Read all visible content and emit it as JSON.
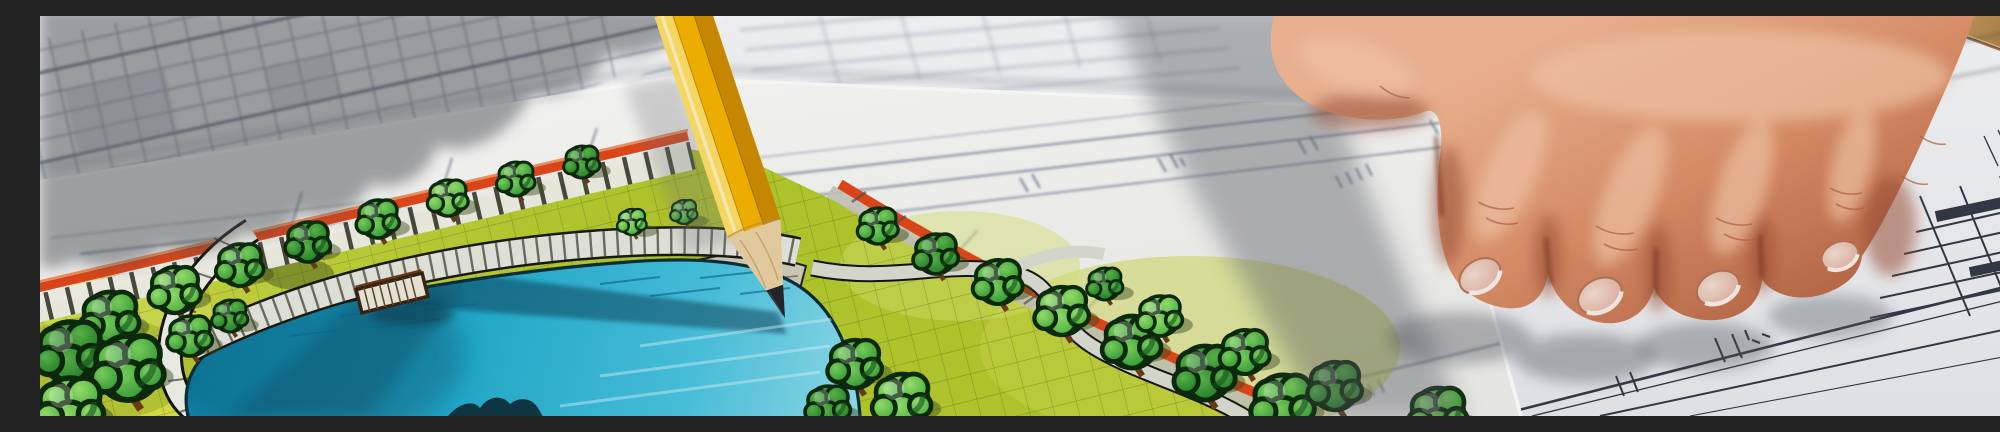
{
  "image": {
    "type": "photograph",
    "caption": "Close-up of a landscape architecture site plan: a hand rests on blueprints at right while a yellow pencil points at a hand-coloured park plan with a turquoise pond, lawns and trees",
    "width_px": 2000,
    "height_px": 400
  },
  "scene": {
    "objects": [
      {
        "name": "landscape-plan-sheet",
        "label": "Hand-coloured landscape site plan sheet"
      },
      {
        "name": "pond",
        "label": "Turquoise marker-rendered pond with dock"
      },
      {
        "name": "boardwalk",
        "label": "Curved plank boardwalk along pond shore"
      },
      {
        "name": "curved-path",
        "label": "White curved footpath around pond"
      },
      {
        "name": "orange-road-border",
        "label": "Orange road band along plan edge"
      },
      {
        "name": "tree-row",
        "label": "Rows of round sketched trees"
      },
      {
        "name": "pencil",
        "label": "Yellow pencil touching the shoreline"
      },
      {
        "name": "architect-hand",
        "label": "Hand resting on blueprint"
      },
      {
        "name": "blueprint-sheets",
        "label": "Technical blueprint sheets with dimension lines"
      },
      {
        "name": "table-corner",
        "label": "Wooden table corner, top right"
      }
    ],
    "lighting": "hard sunlight from upper right, hand and pencil cast soft grey shadows to the left"
  },
  "plan": {
    "trees": [
      [
        70,
        302,
        26,
        "a"
      ],
      [
        135,
        274,
        23,
        "b"
      ],
      [
        200,
        249,
        21,
        "a"
      ],
      [
        268,
        226,
        20,
        "c"
      ],
      [
        338,
        203,
        19,
        "a"
      ],
      [
        408,
        182,
        18,
        "b"
      ],
      [
        476,
        163,
        17,
        "a"
      ],
      [
        542,
        146,
        16,
        "c"
      ],
      [
        30,
        336,
        30,
        "c"
      ],
      [
        88,
        352,
        32,
        "a"
      ],
      [
        30,
        392,
        30,
        "b"
      ],
      [
        150,
        320,
        20,
        "a"
      ],
      [
        190,
        300,
        16,
        "c"
      ],
      [
        592,
        206,
        13,
        "b"
      ],
      [
        644,
        196,
        12,
        "a"
      ],
      [
        695,
        189,
        12,
        "c"
      ],
      [
        838,
        210,
        18,
        "a"
      ],
      [
        896,
        238,
        20,
        "c"
      ],
      [
        958,
        266,
        22,
        "a"
      ],
      [
        1022,
        295,
        24,
        "b"
      ],
      [
        1092,
        326,
        26,
        "a"
      ],
      [
        1165,
        357,
        27,
        "c"
      ],
      [
        1243,
        387,
        28,
        "a"
      ],
      [
        1120,
        300,
        20,
        "b"
      ],
      [
        1205,
        336,
        22,
        "a"
      ],
      [
        1295,
        370,
        24,
        "c"
      ],
      [
        1398,
        398,
        26,
        "a"
      ],
      [
        1065,
        268,
        16,
        "c"
      ],
      [
        815,
        348,
        24,
        "a"
      ],
      [
        862,
        384,
        26,
        "b"
      ],
      [
        788,
        390,
        20,
        "c"
      ]
    ]
  },
  "palette": {
    "paper": "#f4f5f7",
    "paper_shadow": "#9b9ca3",
    "blueprint_line": "#56647f",
    "blueprint_line_dark": "#333a46",
    "plan_orange": "#e2481b",
    "lawn": "#c3d435",
    "lawn_light": "#e6e750",
    "lawn_dark": "#97ad24",
    "tree_green_mid": "#3fae3c",
    "tree_green_light": "#5ec44f",
    "tree_green_dark": "#2c8f31",
    "pond_deep": "#0f8fb6",
    "pond_mid": "#2ab5d8",
    "pond_light": "#b4ecf5",
    "path_white": "#f1f2ea",
    "plaza_stone": "#d3cdbb",
    "pencil_yellow": "#f7b500",
    "pencil_yellow_light": "#ffdf66",
    "pencil_yellow_dark": "#cf8d00",
    "pencil_wood": "#ecd2a4",
    "pencil_graphite": "#26262a",
    "skin_light": "#f2b795",
    "skin_mid": "#d88a64",
    "skin_shadow": "#9c4f36",
    "nail": "#e9c6b6",
    "wood_table": "#bb8d55",
    "shadow_gray": "#55565c"
  }
}
